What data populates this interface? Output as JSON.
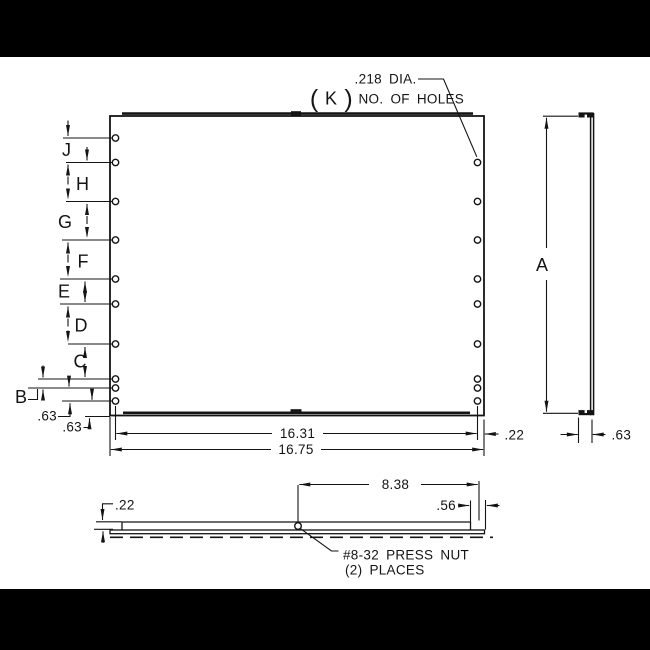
{
  "hole_callout": {
    "diameter": ".218 DIA.",
    "count_open_paren": "(",
    "count_letter": "K",
    "count_close_paren": ")",
    "count_label": "NO. OF HOLES"
  },
  "front_view": {
    "spacing_labels": {
      "J": "J",
      "H": "H",
      "G": "G",
      "F": "F",
      "E": "E",
      "D": "D",
      "C": "C",
      "B": "B"
    },
    "bottom_spacing_1": ".63",
    "bottom_spacing_2": ".63",
    "hole_span_width": "16.31",
    "overall_width": "16.75",
    "edge_margin": ".22"
  },
  "side_view": {
    "height_label": "A",
    "flange_depth": ".63"
  },
  "bottom_view": {
    "flange_offset": ".22",
    "nut_distance": "8.38",
    "lip_edge_offset": ".56",
    "nut_note_line1": "#8-32 PRESS NUT",
    "nut_note_line2": "(2) PLACES"
  }
}
